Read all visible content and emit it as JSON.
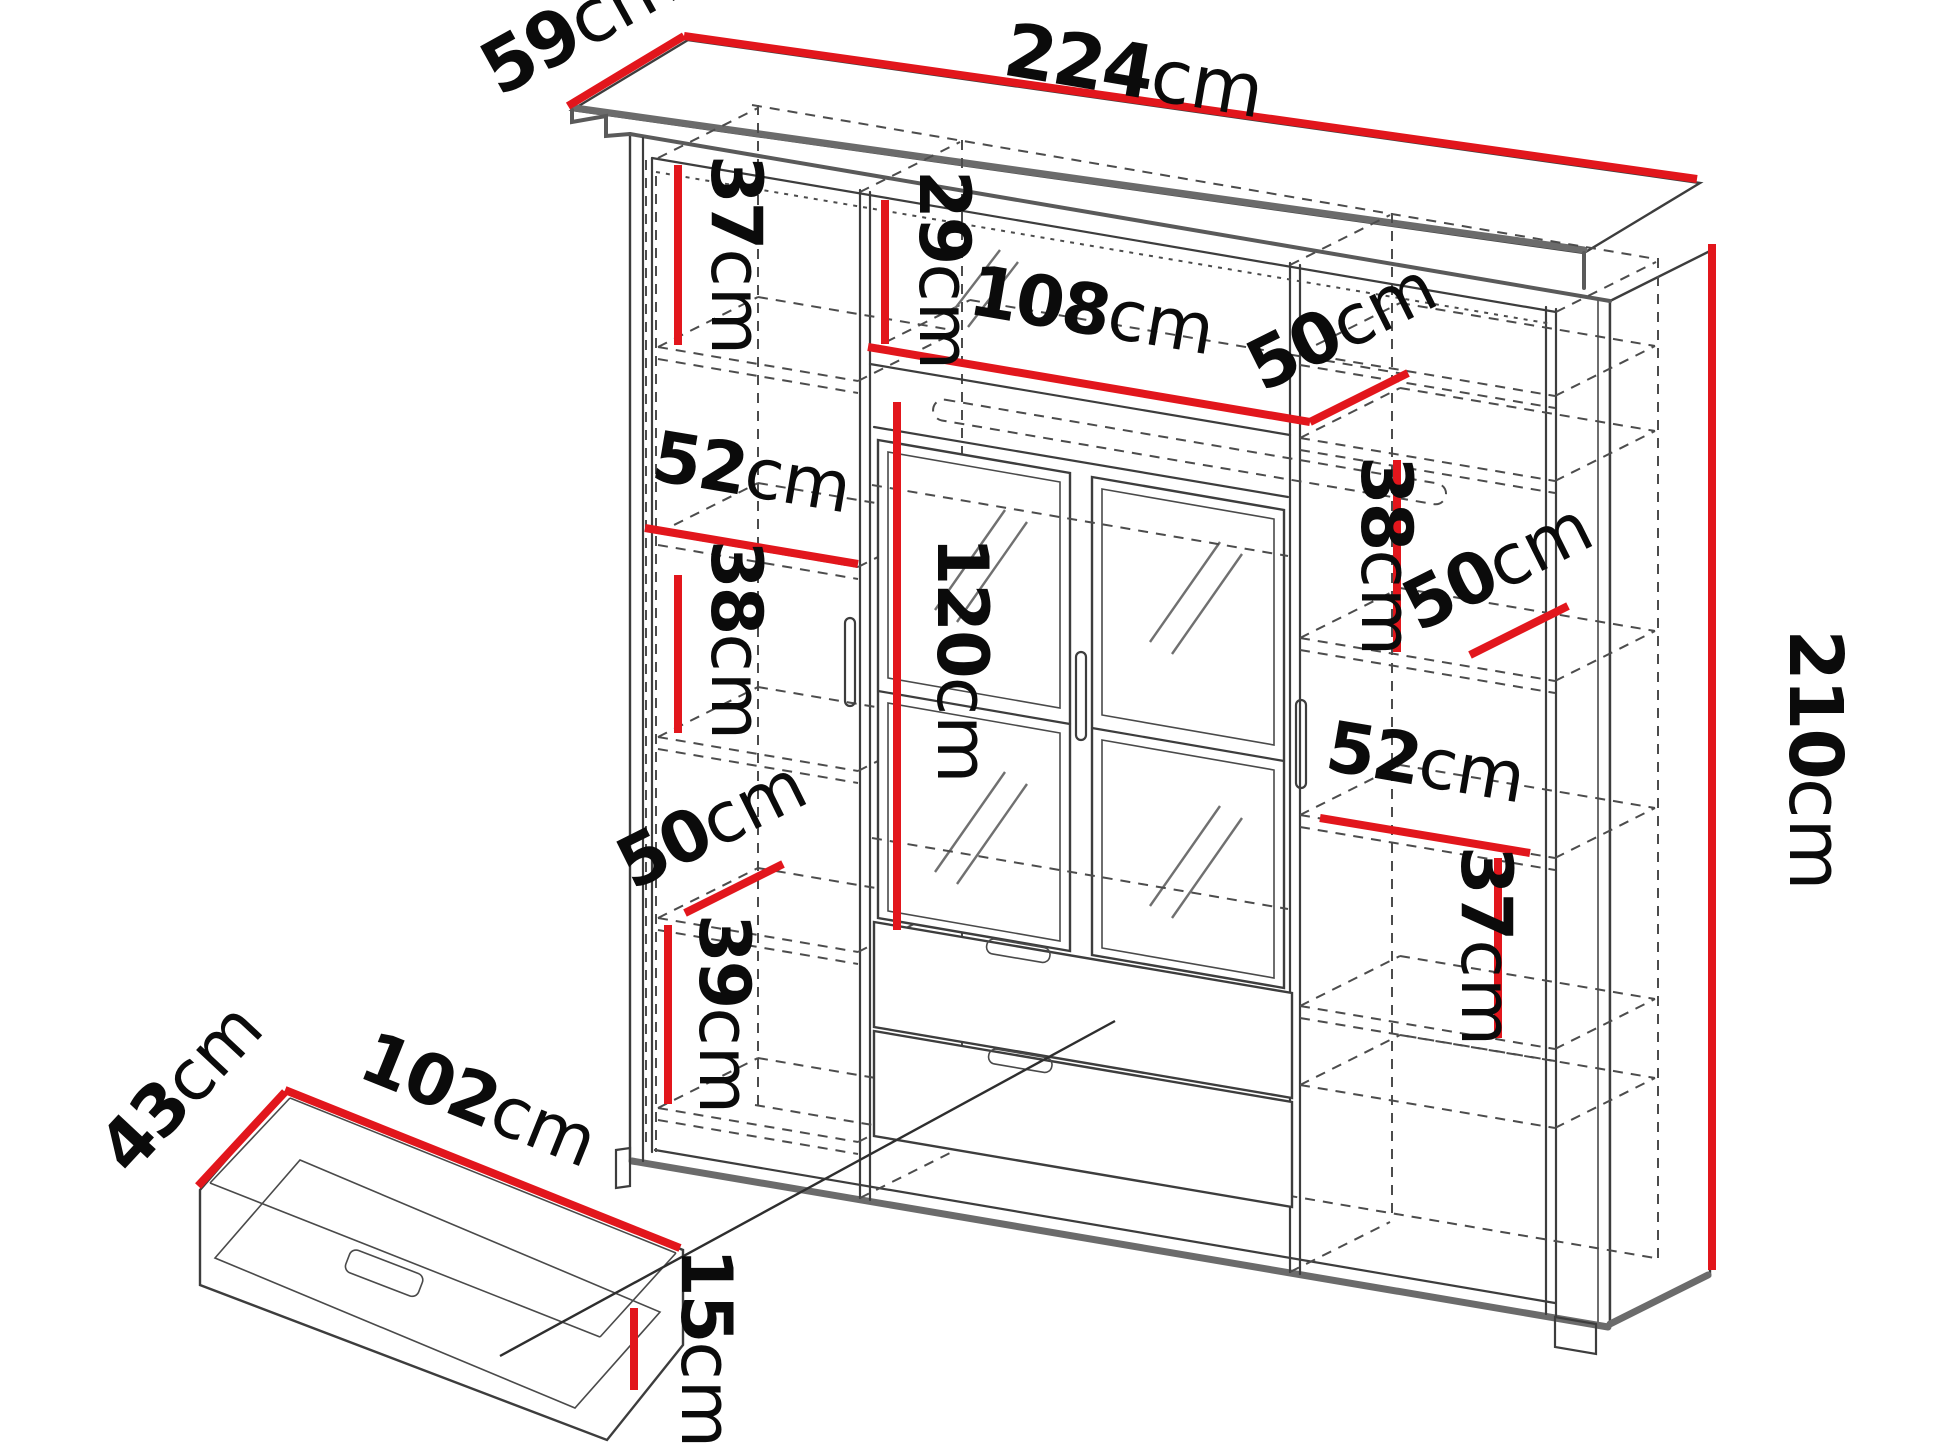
{
  "diagram": {
    "type": "furniture-dimension-diagram",
    "subject": "wardrobe-with-mirrored-doors-and-underbed-drawer",
    "unit": "cm",
    "colors": {
      "dimension_line": "#e2161c",
      "outline": "#3d3d3d",
      "label_text": "#0b0b0b",
      "background": "#ffffff"
    },
    "wardrobe": {
      "width": {
        "value": "224",
        "unit": "cm"
      },
      "depth": {
        "value": "59",
        "unit": "cm"
      },
      "height": {
        "value": "210",
        "unit": "cm"
      },
      "left_column": {
        "top_gap": {
          "value": "37",
          "unit": "cm"
        },
        "shelf_width": {
          "value": "52",
          "unit": "cm"
        },
        "middle_gap": {
          "value": "38",
          "unit": "cm"
        },
        "shelf_depth": {
          "value": "50",
          "unit": "cm"
        },
        "bottom_gap": {
          "value": "39",
          "unit": "cm"
        }
      },
      "center_column": {
        "top_gap": {
          "value": "29",
          "unit": "cm"
        },
        "inner_width": {
          "value": "108",
          "unit": "cm"
        },
        "shelf_depth": {
          "value": "50",
          "unit": "cm"
        },
        "door_height": {
          "value": "120",
          "unit": "cm"
        }
      },
      "right_column": {
        "upper_gap": {
          "value": "38",
          "unit": "cm"
        },
        "shelf_depth": {
          "value": "50",
          "unit": "cm"
        },
        "shelf_width": {
          "value": "52",
          "unit": "cm"
        },
        "lower_gap": {
          "value": "37",
          "unit": "cm"
        }
      }
    },
    "drawer": {
      "depth": {
        "value": "43",
        "unit": "cm"
      },
      "width": {
        "value": "102",
        "unit": "cm"
      },
      "height": {
        "value": "15",
        "unit": "cm"
      }
    }
  }
}
